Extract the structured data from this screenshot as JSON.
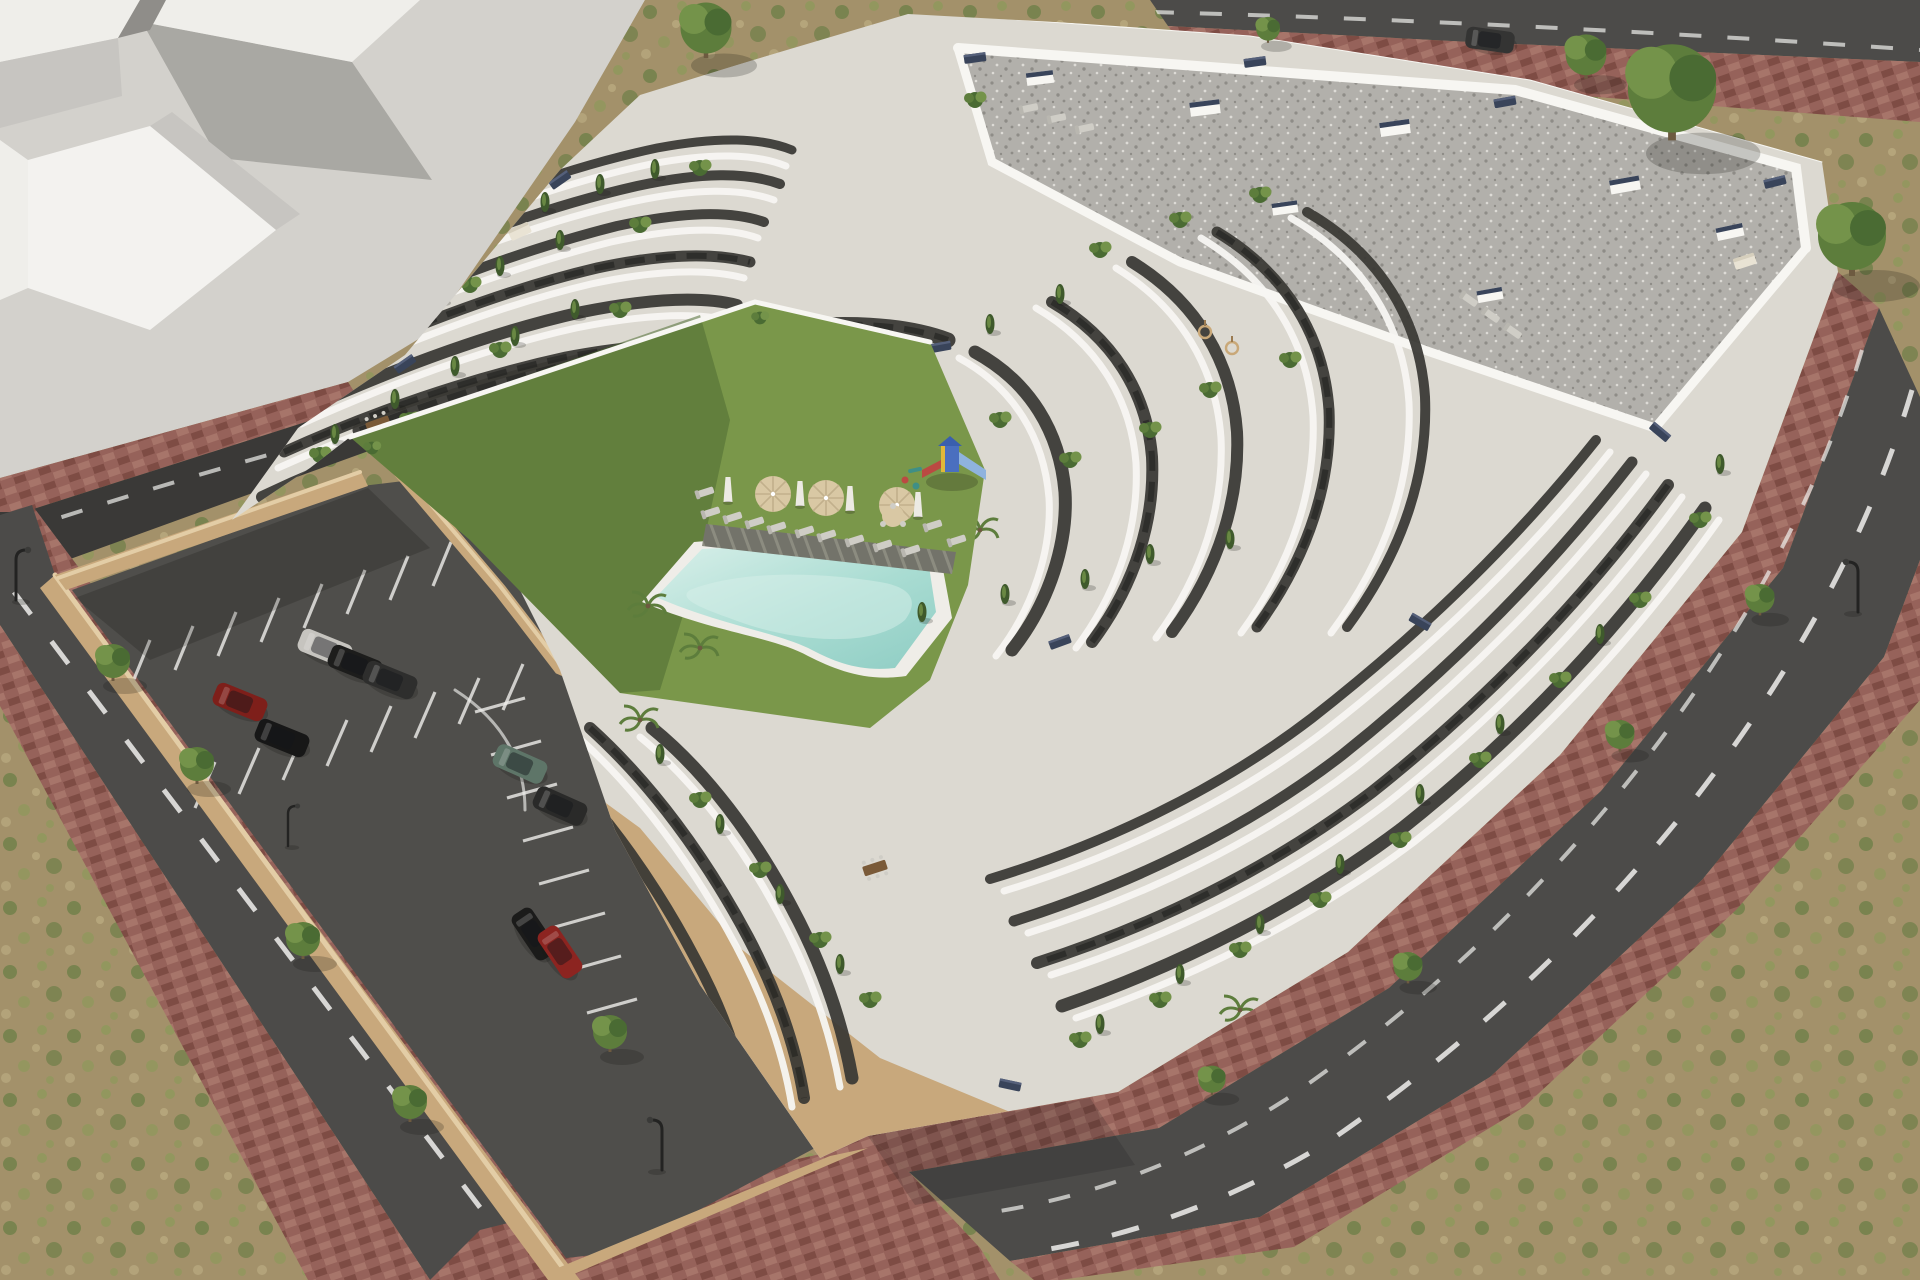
{
  "scene": {
    "kind": "aerial-architectural-render",
    "subject": "Modern white terraced apartment complex with curved balcony bands, gravel flat roof, landscaped courtyard with free-form swimming pool, sun loungers, parasols and playground, sunken parking lot with marked bays and cars, perimeter roads with red paver sidewalks, street trees and lamps, surrounded by scrubland and an abstract grey neighbouring block",
    "colors": {
      "plaza": "#d3d1cc",
      "blockTop": "#efeeea",
      "blockFace": "#f3f2ef",
      "blockSide": "#c7c5c1",
      "blockDark": "#8f8d89",
      "scrubBase": "#a3916a",
      "scrubGreen1": "#6e7f48",
      "scrubGreen2": "#8a9a58",
      "scrubTan": "#b7a87e",
      "road": "#4c4b49",
      "roadDark": "#3a3937",
      "parkingAsphalt": "#4f4e4b",
      "paverBase": "#96625a",
      "paverLight": "#a7756a",
      "paverDark": "#7e4c44",
      "curb": "#c9b699",
      "wallTan": "#c8a87c",
      "wallTanLight": "#e3cda6",
      "bldgBase": "#dcd9d1",
      "parapet": "#f7f6f2",
      "facadeDark": "#3a3935",
      "glassDark": "#1d1d1c",
      "gravelBase": "#b2b0ab",
      "gravelDot1": "#8e8c87",
      "gravelDot2": "#dddbd6",
      "lawn": "#7a974a",
      "lawnShade": "#4f6c33",
      "poolRim": "#efede8",
      "poolLight": "#d8efe9",
      "poolMid": "#a9dcd2",
      "poolDeep": "#8fcdc4",
      "deckPlank": "#73736a",
      "deckPlankLight": "#8c8c80",
      "green1": "#4a6b33",
      "green2": "#5d7d3c",
      "green3": "#74934a",
      "cypress": "#3f5a2c",
      "trunk": "#6d5a40",
      "planterNavy": "#39445a",
      "woodBrown": "#7a5a38",
      "furnGray": "#cfcdc6",
      "umbBeige": "#d9c8a4",
      "cream": "#e9e3d4",
      "markWhite": "#f0efec",
      "lampBlack": "#232322",
      "playBlue": "#4a6fbf",
      "playRoof": "#3a5fae",
      "playSlide": "#8fb3de",
      "playYellow": "#e0b83a",
      "playRed": "#bb4a42",
      "playTeal": "#3f8f86",
      "shadow": "rgba(25,25,20,0.22)"
    },
    "courtyard": {
      "parasol_count": 3,
      "folded_parasol_count": 4,
      "lounger_count": 12,
      "has_pool": true,
      "has_timber_deck": true,
      "has_playground": true
    },
    "parking": {
      "bays_marked": true,
      "retaining_wall": true
    },
    "cars": [
      {
        "label": "silver-sedan",
        "color": "#c6c4bf"
      },
      {
        "label": "black-hatch",
        "color": "#1d1d1c"
      },
      {
        "label": "graphite-sedan",
        "color": "#2e2e2d"
      },
      {
        "label": "red-hatchback",
        "color": "#7e1f1a"
      },
      {
        "label": "black-sedan",
        "color": "#171717"
      },
      {
        "label": "green-offroader",
        "color": "#5e7568"
      },
      {
        "label": "graphite-coupe",
        "color": "#2a2a29"
      },
      {
        "label": "black-sedan",
        "color": "#1b1b1a"
      },
      {
        "label": "red-sedan",
        "color": "#8c2420"
      },
      {
        "label": "graphite-sedan",
        "color": "#343433"
      }
    ]
  }
}
